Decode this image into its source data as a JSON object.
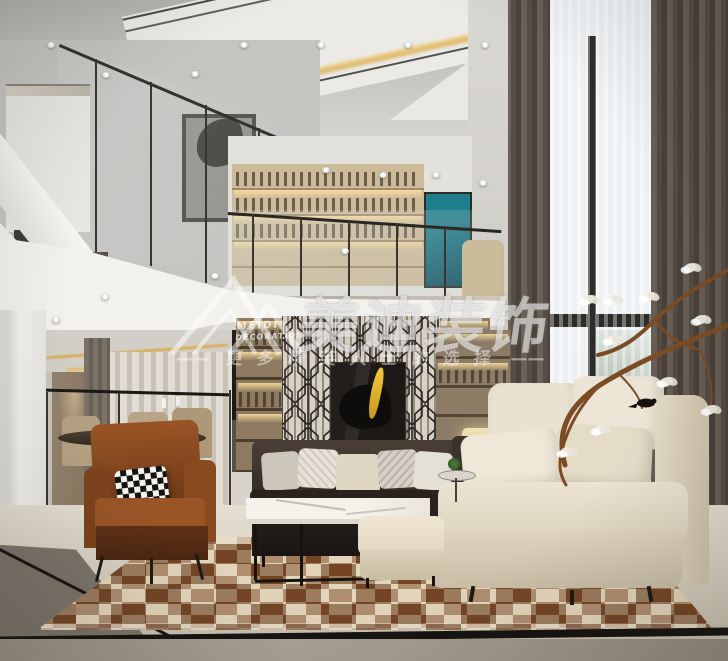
{
  "image": {
    "type": "interior-design-rendering",
    "subject": "Modern duplex living room: double-height ceiling, mezzanine study with bookshelves, tall curtained windows, leather and cream sofas, patchwork rug"
  },
  "watermark": {
    "logo_icon": "mountain-roof-logo",
    "logo_line1": "MEIDI",
    "logo_line2": "DECORATION",
    "brand": "美迪装饰",
    "dash_left": "——",
    "dash_right": "——",
    "tagline": "更多精英人士的选择"
  },
  "palette": {
    "wall_white": "#eceae6",
    "ceiling_gray": "#c6c5c2",
    "cove_gold": "#e2bd72",
    "shelf_wood": "#c4b191",
    "curtain_taupe": "#5e564d",
    "sheer_white": "#e9edf0",
    "leather_caramel": "#8f4e22",
    "sofa_dark_brown": "#2e2620",
    "sofa_cream": "#e8e0cd",
    "marble_cream": "#e3ddd0",
    "floor_gray_marble": "#a29a8d",
    "rug_brown": "#8a5a35",
    "rug_cream": "#d9c8a8",
    "teal_artwork": "#176b7c",
    "art_accent_yellow": "#e3b324",
    "watermark_white": "#ffffff"
  }
}
